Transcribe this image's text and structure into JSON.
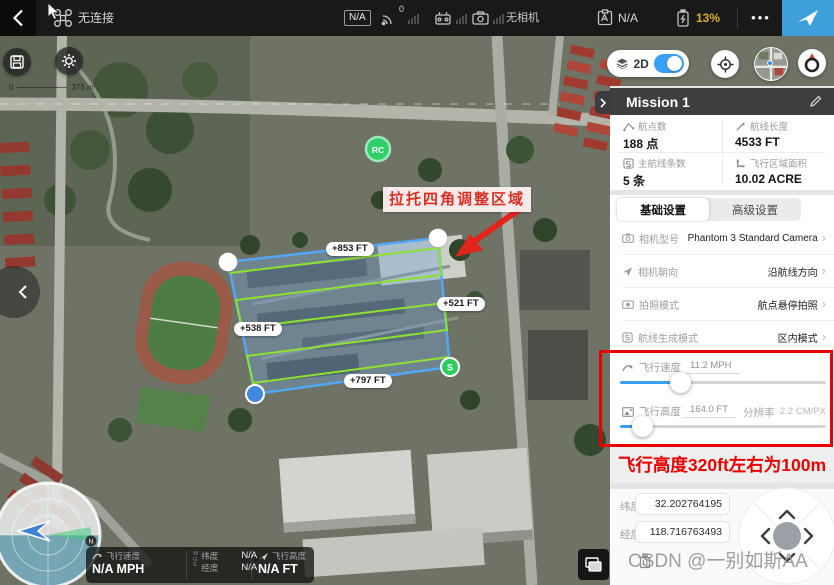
{
  "topbar": {
    "connection_status": "无连接",
    "gps_badge": "N/A",
    "sat_count": "0",
    "camera_status": "无相机",
    "rc_status_badge": "N/A",
    "battery": "13%",
    "battery_color": "#d7af2e",
    "menu_dots": "•••"
  },
  "map": {
    "scale_start": "0",
    "scale_end": "375 m",
    "annotation": "拉托四角调整区域",
    "edge_labels": [
      "+853 FT",
      "+521 FT",
      "+538 FT",
      "+797 FT"
    ],
    "rc_marker": "RC",
    "start_marker": "S",
    "compass_north": "N",
    "toggle_2d_label": "2D"
  },
  "telemetry": {
    "speed_label": "飞行速度",
    "speed_value": "N/A MPH",
    "wgs": "W\nG\nS",
    "lat_label": "纬度",
    "lat_value": "N/A",
    "lng_label": "经度",
    "lng_value": "N/A",
    "alt_label": "飞行高度",
    "alt_value": "N/A FT"
  },
  "panel": {
    "mission_title": "Mission 1",
    "stats": [
      {
        "label": "航点数",
        "value": "188 点"
      },
      {
        "label": "航线长度",
        "value": "4533 FT"
      },
      {
        "label": "主航线条数",
        "value": "5 条"
      },
      {
        "label": "飞行区域面积",
        "value": "10.02 ACRE"
      }
    ],
    "tabs": {
      "basic": "基础设置",
      "advanced": "高级设置"
    },
    "settings": [
      {
        "label": "相机型号",
        "value": "Phantom 3 Standard Camera"
      },
      {
        "label": "相机朝向",
        "value": "沿航线方向"
      },
      {
        "label": "拍照模式",
        "value": "航点悬停拍照"
      },
      {
        "label": "航线生成模式",
        "value": "区内模式"
      }
    ],
    "sliders": {
      "speed_label": "飞行速度",
      "speed_value": "11.2 MPH",
      "alt_label": "飞行高度",
      "alt_value": "164.0 FT",
      "res_label": "分辨率",
      "res_value": "2.2 CM/PX"
    },
    "note": "飞行高度320ft左右为100m",
    "coords": {
      "lat_label": "纬度",
      "lat_value": "32.202764195",
      "lng_label": "经度",
      "lng_value": "118.716763493"
    }
  },
  "watermark": "CSDN @一别如斯AA",
  "colors": {
    "accent_blue": "#3aa0f5",
    "annotation_red": "#e60000",
    "route_green": "#8ce22f",
    "polygon_blue": "#52a8f7"
  }
}
